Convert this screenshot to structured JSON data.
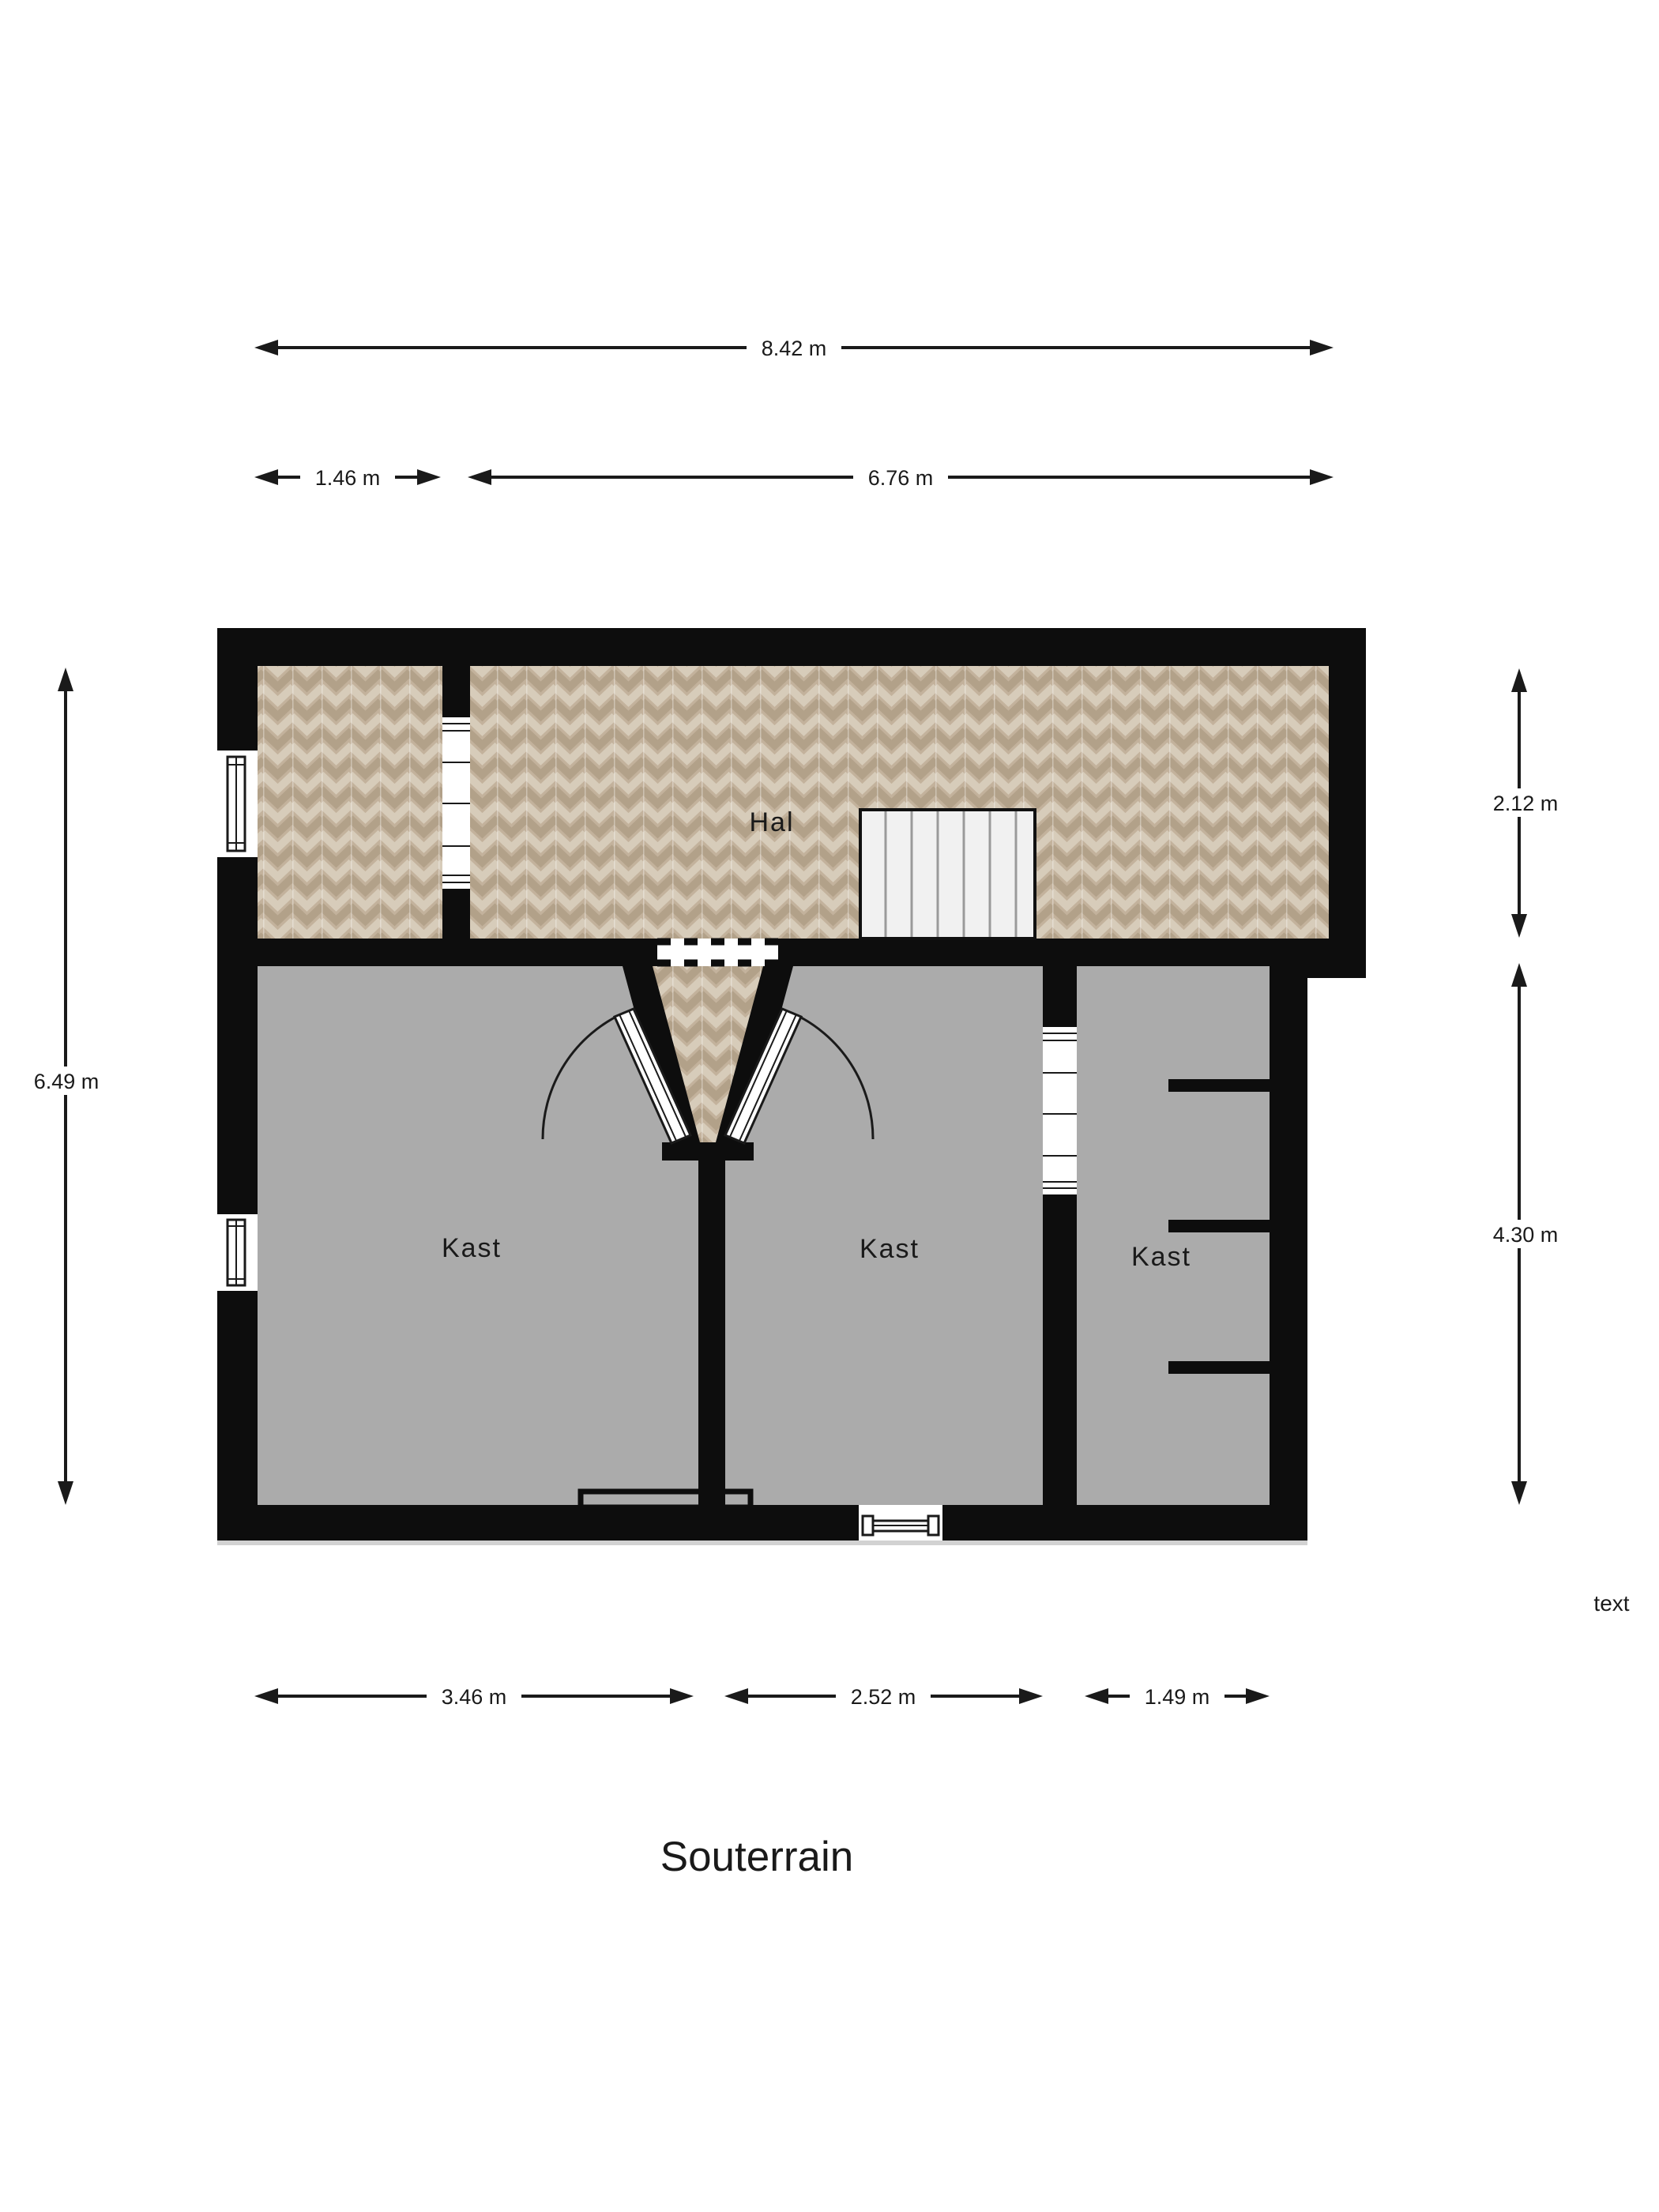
{
  "plan": {
    "title": "Souterrain",
    "floor_note": "text",
    "room_labels": {
      "hal": "Hal",
      "kast_left": "Kast",
      "kast_middle": "Kast",
      "kast_right": "Kast"
    },
    "dimensions": {
      "total_width": "8.42 m",
      "top_left_width": "1.46 m",
      "top_right_width": "6.76 m",
      "total_height": "6.49 m",
      "hal_height": "2.12 m",
      "lower_height": "4.30 m",
      "bottom_left_width": "3.46 m",
      "bottom_middle_width": "2.52 m",
      "bottom_right_width": "1.49 m"
    },
    "colors": {
      "wall": "#0d0d0d",
      "wood_floor_base": "#c3b29c",
      "wood_floor_dark": "#b2a189",
      "wood_floor_light": "#d7ccba",
      "gray_floor": "#ababab",
      "stairs_fill": "#f1f1f1",
      "shadow": "#d2d2d2"
    }
  }
}
